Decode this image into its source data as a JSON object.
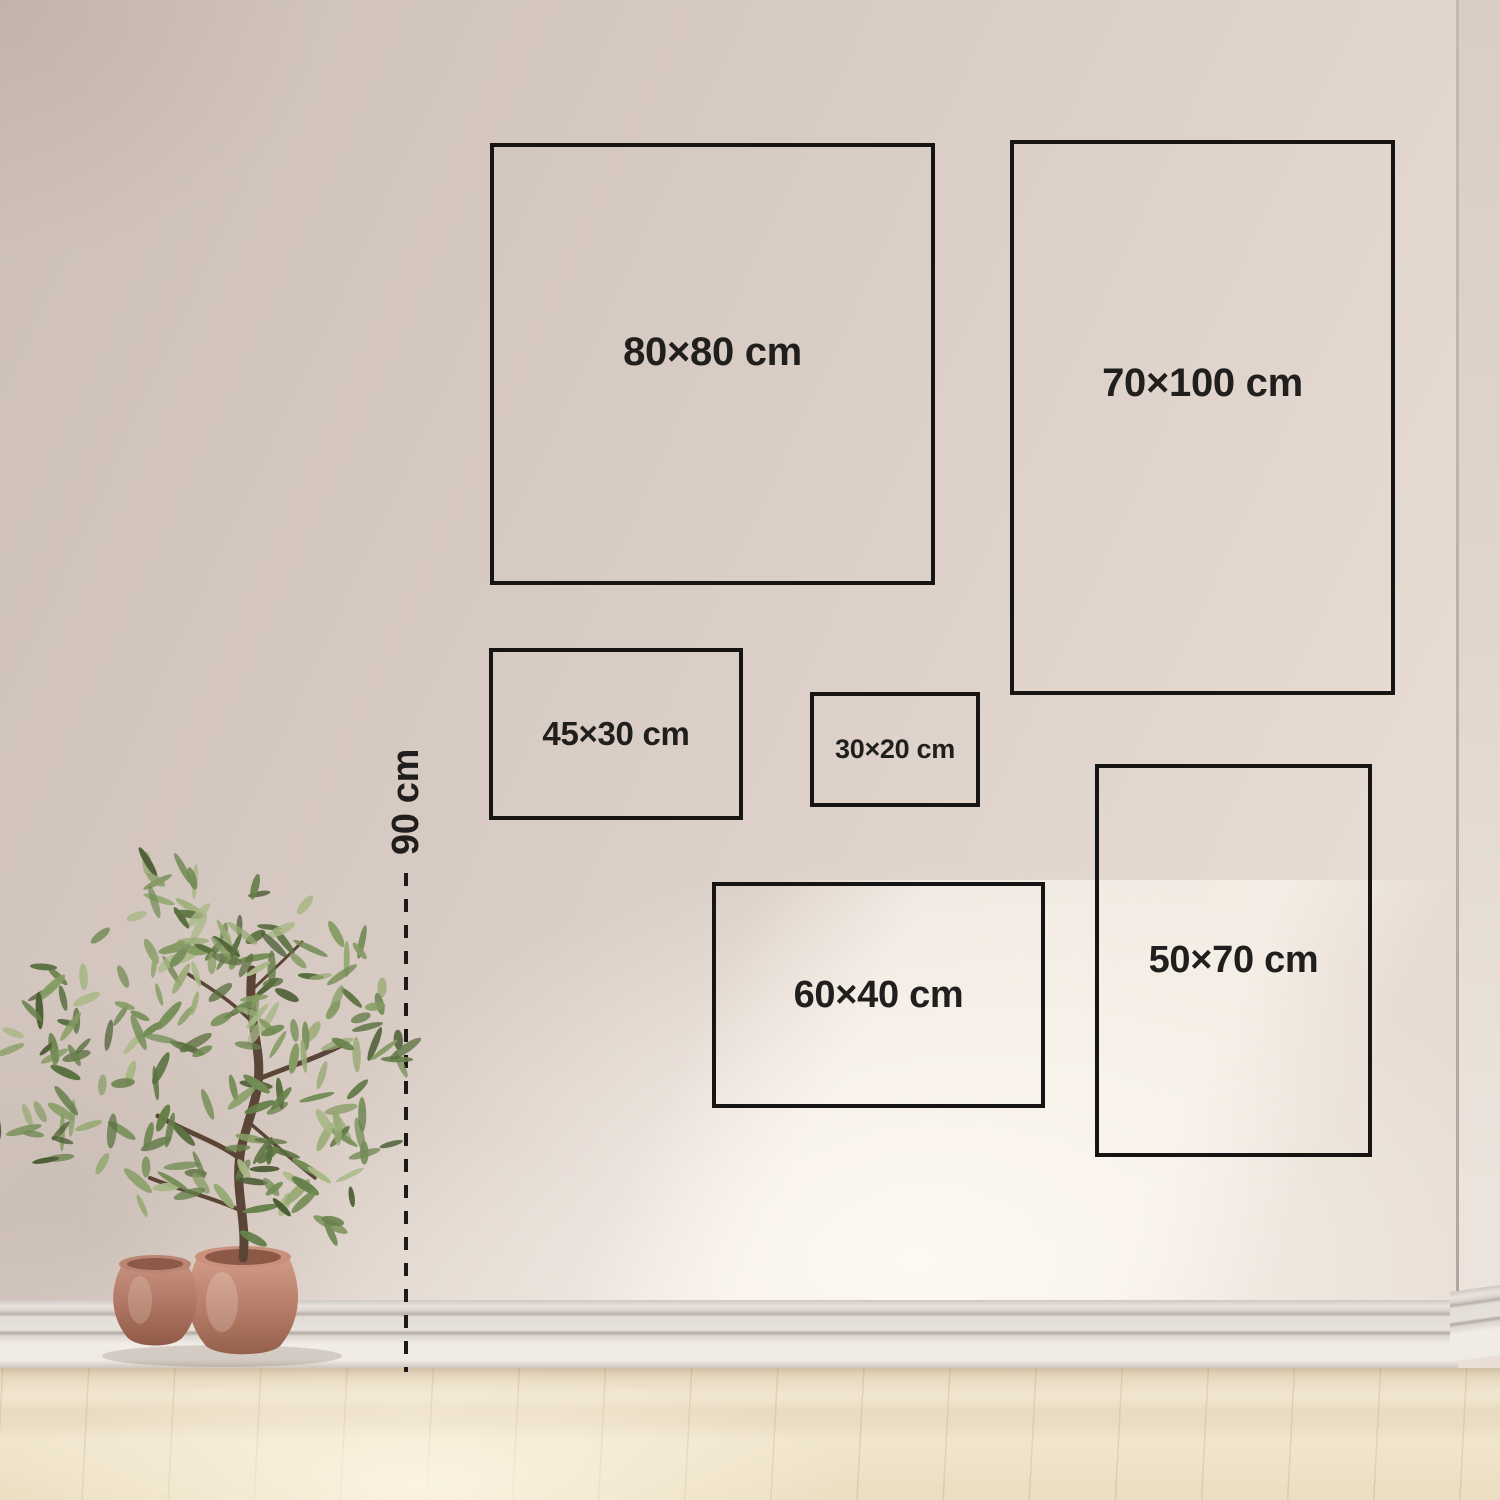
{
  "size_guide": {
    "boxes": [
      {
        "id": "80x80",
        "label": "80×80 cm",
        "width_cm": 80,
        "height_cm": 80
      },
      {
        "id": "70x100",
        "label": "70×100 cm",
        "width_cm": 70,
        "height_cm": 100
      },
      {
        "id": "45x30",
        "label": "45×30 cm",
        "width_cm": 45,
        "height_cm": 30
      },
      {
        "id": "30x20",
        "label": "30×20 cm",
        "width_cm": 30,
        "height_cm": 20
      },
      {
        "id": "60x40",
        "label": "60×40 cm",
        "width_cm": 60,
        "height_cm": 40
      },
      {
        "id": "50x70",
        "label": "50×70 cm",
        "width_cm": 50,
        "height_cm": 70
      }
    ],
    "height_marker": {
      "label": "90 cm",
      "value_cm": 90
    }
  },
  "colors": {
    "outline": "#171513",
    "text": "#211f1d",
    "wall_dark": "#cdbfb7",
    "wall_light": "#f3ece4",
    "floor_wood": "#efe3cb",
    "baseboard": "#e9e3dc",
    "pot_terracotta": "#c28b78",
    "foliage_green": "#66804a",
    "trunk_brown": "#5a4536"
  }
}
